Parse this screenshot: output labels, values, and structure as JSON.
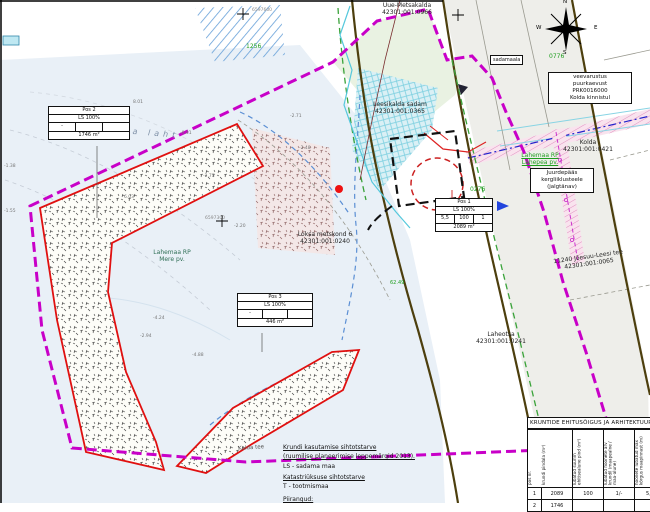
{
  "colors": {
    "plan_boundary": "#c800c8",
    "plot_outline": "#e01010",
    "road": "#4d3f0e",
    "water_dash": "#5b8fd4",
    "sea_fill": "#e9f0f7"
  },
  "labels": {
    "uue_metsakalda": "Uue-Metsakalda\n42301:001:0966",
    "leesikalda_sadam": "Leesikalda sadam\n42301:001:0365",
    "kolda": "Kolda\n42301:001:0421",
    "loksa_metskond": "Loksa metskond 6\n42301:001:0240",
    "lahemaa_mere": "Lahemaa RP\nMere pv.",
    "lahemaa_lahepea": "Lahemaa RP\nLahepea pv.",
    "juminda_leesi": "11240 Jõesuu-Leesi tee\n42301:001:0065",
    "laheotsa": "Laheotsa\n42301:001:0241",
    "kolga_laht": "Kolga laht",
    "kalda_tee": "Kalda tee",
    "sadamaala": "sadamaala",
    "veevarustus": "veevarustus\npuurkaevust\nPRK0016000\nKolda kinnistul",
    "juurdepaas": "Juurdepääs\nkergliiklusteele\n(jalgtänav)",
    "parcel_no_1": "1256",
    "parcel_no_2": "0276",
    "parcel_no_3": "0776",
    "dim_6249": "62.49",
    "coord_1": "6597600",
    "coord_2": "6597300"
  },
  "compass": {
    "n": "N",
    "e": "E",
    "s": "S",
    "w": "W"
  },
  "spots": [
    "-2.71",
    "-2.48",
    "-0.41",
    "-2.73",
    "-4.24",
    "-2.94",
    "-4.88",
    "-1.55",
    "-1.38",
    "-2.20",
    "8.01",
    "6.03"
  ],
  "pos_tables": [
    {
      "title": "Pos 1",
      "use": "LS 100%",
      "c1": "5,5",
      "c2": "100",
      "c3": "1",
      "area": "2089 m²"
    },
    {
      "title": "Pos 2",
      "use": "LS 100%",
      "c1": "-",
      "c2": "",
      "c3": "",
      "area": "1746 m²"
    },
    {
      "title": "Pos 3",
      "use": "LS 100%",
      "c1": "-",
      "c2": "",
      "c3": "",
      "area": "446 m²"
    }
  ],
  "building_rights_table": {
    "title": "KRUNTIDE EHITUSÕIGUS JA ARHITEKTUURINÕUDED",
    "headers": [
      "pos nr.",
      "krundi pindala (m²)",
      "lubatud suurim ehitisealune pind (m²)",
      "lubatud hoonete arv krundil (maapealne / maa-alune)",
      "hoonete lubatud max kõrgus maapinnast (m)"
    ],
    "rows": [
      [
        "1",
        "2089",
        "100",
        "1/-",
        "5,5"
      ],
      [
        "2",
        "1746",
        "",
        "",
        ""
      ]
    ]
  },
  "legend": {
    "h1": "Krundi kasutamise sihtotstarve",
    "s1": "(ruumilise planeerimise leppemärgid 2013).",
    "v1": "LS - sadama maa",
    "h2": "Katastriüksuse sihtotstarve",
    "v2": "T - tootmismaa",
    "h3": "Piirangud:"
  }
}
